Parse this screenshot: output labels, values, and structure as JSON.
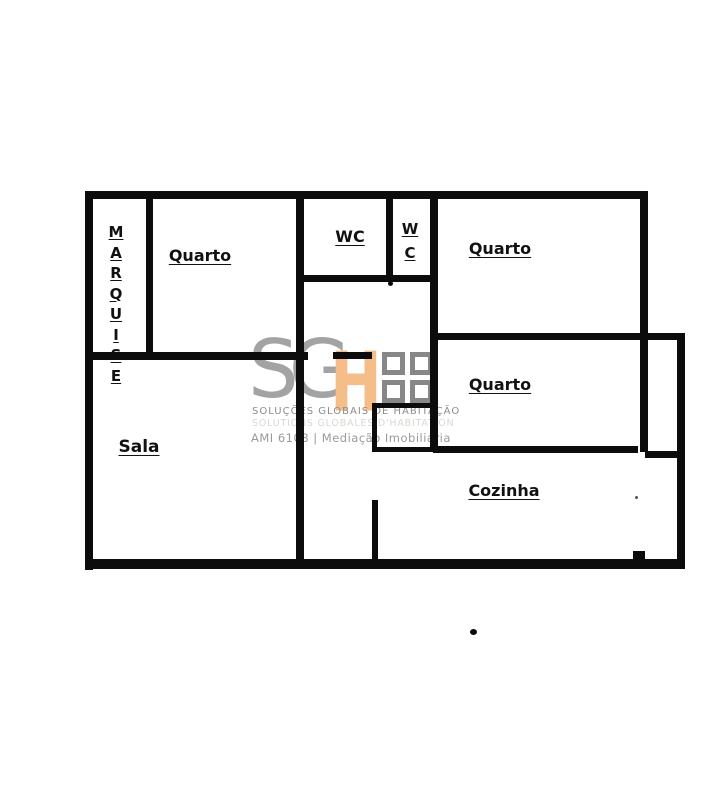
{
  "floorplan": {
    "wall_color": "#0c0c0c",
    "rooms": {
      "marquise": {
        "letters": [
          "M",
          "A",
          "R",
          "Q",
          "U",
          "I",
          "S",
          "E"
        ]
      },
      "quarto_top_left": {
        "label": "Quarto"
      },
      "wc_main": {
        "label": "WC"
      },
      "wc_small": {
        "letters": [
          "W",
          "C"
        ]
      },
      "quarto_top_right": {
        "label": "Quarto"
      },
      "quarto_middle_right": {
        "label": "Quarto"
      },
      "sala": {
        "label": "Sala"
      },
      "cozinha": {
        "label": "Cozinha"
      }
    }
  },
  "watermark": {
    "logo_letters": {
      "s": "S",
      "g": "G",
      "h": "H"
    },
    "accent_orange": "#f5bd88",
    "logo_gray": "#a3a3a3",
    "tagline_pt": "SOLUÇÕES GLOBAIS DE HABITAÇÃO",
    "tagline_ghost": "SOLUTIONS GLOBALES D'HABITATION",
    "license_line": "AMI 6108 | Mediação Imobiliária"
  }
}
